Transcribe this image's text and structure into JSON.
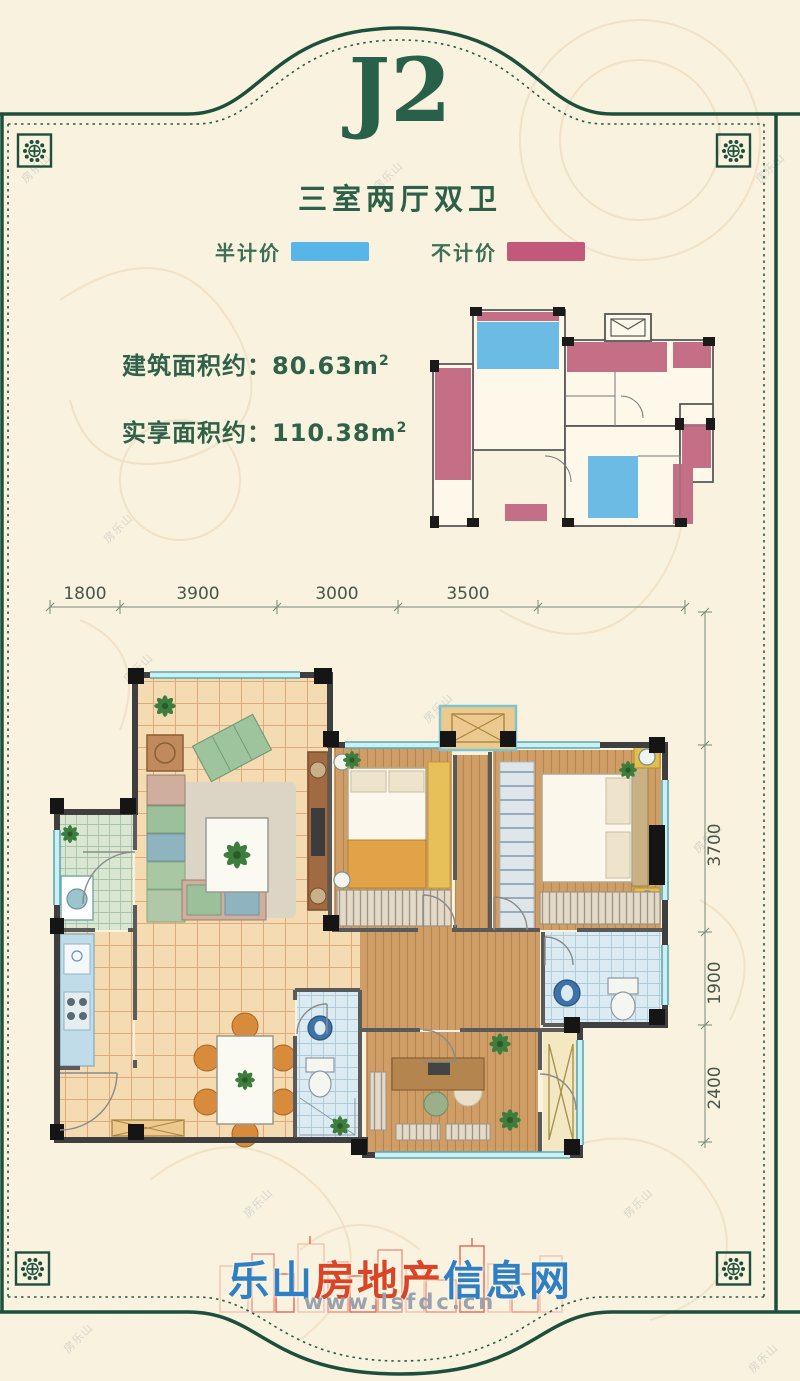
{
  "header": {
    "title": "J2",
    "subtitle": "三室两厅双卫"
  },
  "legend": {
    "items": [
      {
        "label": "半计价",
        "color": "#58b5e8"
      },
      {
        "label": "不计价",
        "color": "#c2587a"
      }
    ]
  },
  "stats": {
    "line1": {
      "label": "建筑面积约：",
      "value": "80.63",
      "unit": "m",
      "sup": "2"
    },
    "line2": {
      "label": "实享面积约：",
      "value": "110.38",
      "unit": "m",
      "sup": "2"
    }
  },
  "dimensions": {
    "top": [
      "1800",
      "3900",
      "3000",
      "3500"
    ],
    "right": [
      "3700",
      "1900",
      "2400"
    ]
  },
  "footer": {
    "logo_blue1": "乐山",
    "logo_red": "房地产",
    "logo_blue2": "信息网",
    "url": "www.lsfdc.cn"
  },
  "watermark": {
    "text": "房乐山"
  },
  "colors": {
    "frame_green": "#1d4f3b",
    "title_green": "#28604a",
    "legend_blue": "#58b5e8",
    "legend_pink": "#c2587a",
    "text_green": "#2f6149",
    "logo_blue": "#2f7fc4",
    "logo_red": "#da4527",
    "wall_dark": "#3f3f3f",
    "window_teal": "#58aab4",
    "floor_tan": "#f5dbb2",
    "floor_wood": "#cf9d66",
    "floor_bath": "#dcebf2"
  }
}
